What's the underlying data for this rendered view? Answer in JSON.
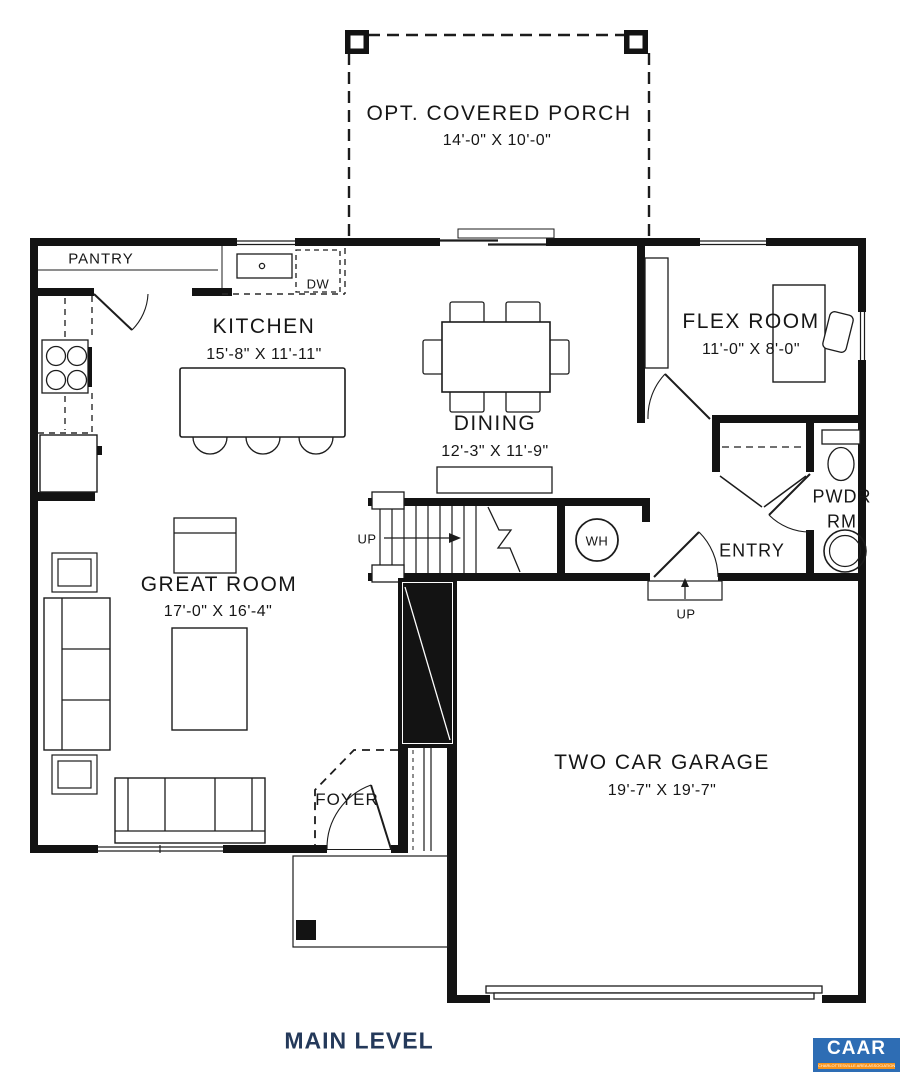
{
  "title": "MAIN LEVEL",
  "rooms": {
    "porch": {
      "name": "OPT. COVERED PORCH",
      "dims": "14'-0\" X 10'-0\""
    },
    "kitchen": {
      "name": "KITCHEN",
      "dims": "15'-8\" X 11'-11\""
    },
    "dining": {
      "name": "DINING",
      "dims": "12'-3\" X 11'-9\""
    },
    "flex_room": {
      "name": "FLEX ROOM",
      "dims": "11'-0\" X 8'-0\""
    },
    "great_room": {
      "name": "GREAT ROOM",
      "dims": "17'-0\" X 16'-4\""
    },
    "garage": {
      "name": "TWO CAR GARAGE",
      "dims": "19'-7\" X 19'-7\""
    },
    "pantry": {
      "name": "PANTRY"
    },
    "powder_room": {
      "line1": "PWDR",
      "line2": "RM"
    },
    "entry": {
      "name": "ENTRY"
    },
    "foyer": {
      "name": "FOYER"
    }
  },
  "annotations": {
    "dishwasher": "DW",
    "water_heater": "WH",
    "stairs_up": "UP",
    "entry_step_up": "UP"
  },
  "logo": {
    "name": "CAAR",
    "tagline": "CHARLOTTESVILLE AREA ASSOCIATION OF REALTORS"
  },
  "colors": {
    "walls": "#131313",
    "lines": "#1c1c1c",
    "title_text": "#24395a",
    "logo_blue": "#2e6db4",
    "logo_orange": "#f7941d"
  }
}
